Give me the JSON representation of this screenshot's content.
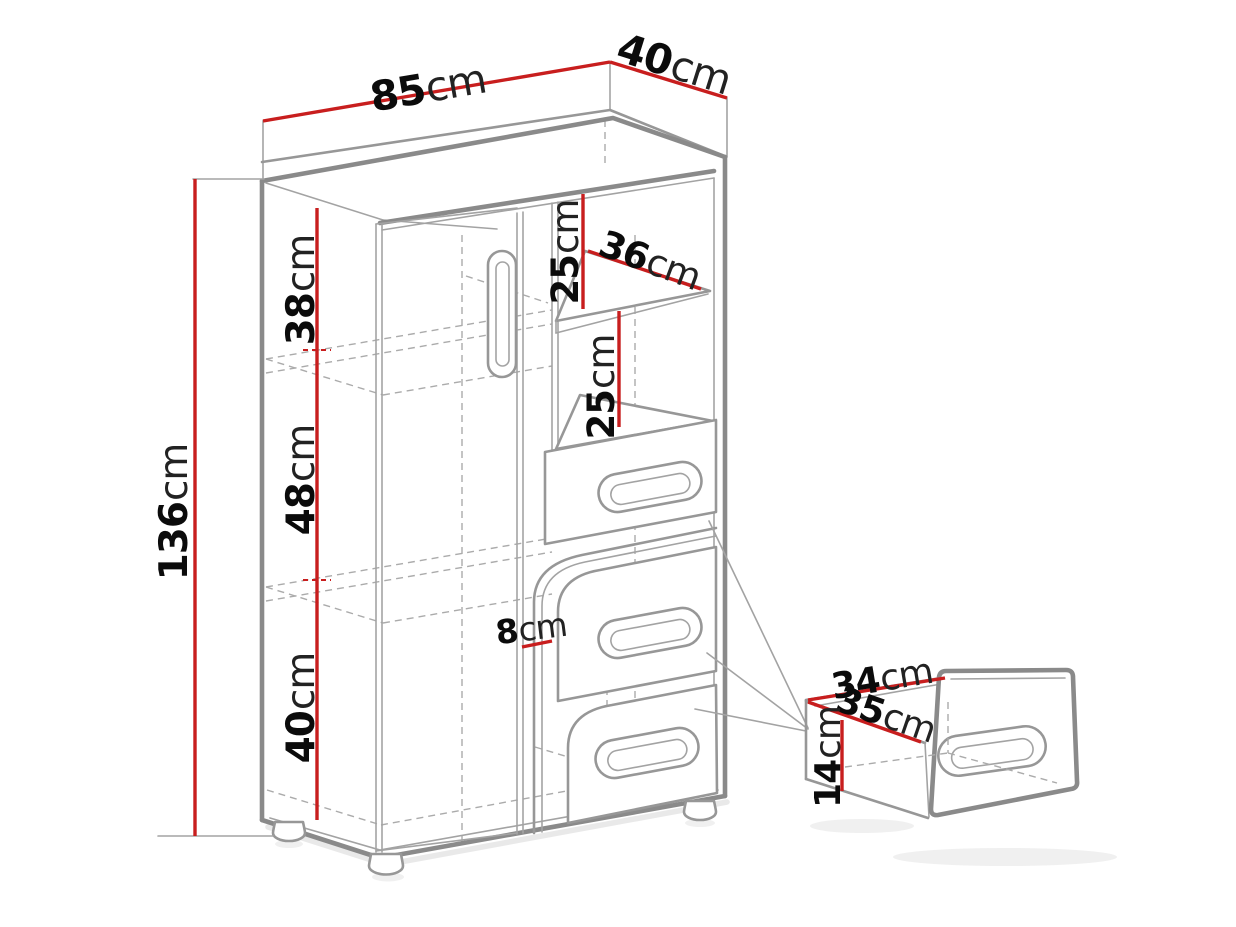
{
  "diagram": {
    "type": "furniture-dimension-drawing",
    "background_color": "#ffffff",
    "line_color": "#8a8a8a",
    "dimension_line_color": "#c81e1e",
    "text_color": "#0b0b0b",
    "dimensions": {
      "width_top": {
        "value": "85",
        "unit": "cm"
      },
      "depth_top": {
        "value": "40",
        "unit": "cm"
      },
      "height_left": {
        "value": "136",
        "unit": "cm"
      },
      "section_upper": {
        "value": "38",
        "unit": "cm"
      },
      "section_middle": {
        "value": "48",
        "unit": "cm"
      },
      "section_lower": {
        "value": "40",
        "unit": "cm"
      },
      "niche_upper": {
        "value": "25",
        "unit": "cm"
      },
      "shelf_width": {
        "value": "36",
        "unit": "cm"
      },
      "niche_lower": {
        "value": "25",
        "unit": "cm"
      },
      "door_gap": {
        "value": "8",
        "unit": "cm"
      },
      "drawer_width": {
        "value": "34",
        "unit": "cm"
      },
      "drawer_depth": {
        "value": "35",
        "unit": "cm"
      },
      "drawer_height": {
        "value": "14",
        "unit": "cm"
      }
    }
  }
}
